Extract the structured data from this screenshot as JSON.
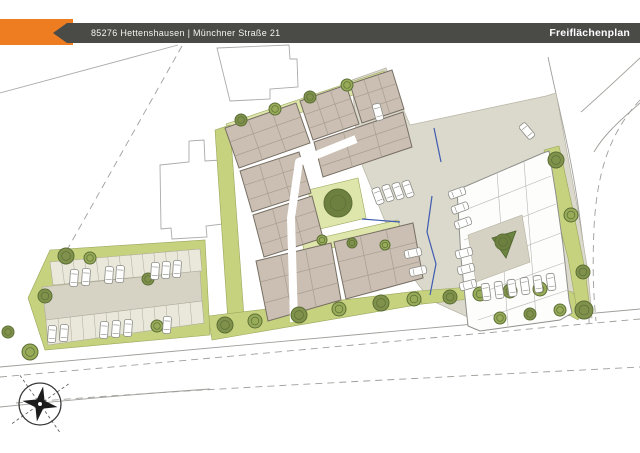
{
  "header": {
    "address": "85276 Hettenshausen | Münchner Straße 21",
    "title": "Freiflächenplan",
    "accent_color": "#ee7d22",
    "bar_color": "#4a4a47",
    "text_color": "#ffffff"
  },
  "plan": {
    "colors": {
      "paved": "#dbd8cc",
      "paved_stroke": "#b7b4a5",
      "green": "#c7d27e",
      "green_light": "#dfe6ab",
      "green_stroke": "#9aa65c",
      "tree_fill": "#7f914b",
      "tree_fill_alt": "#97ab58",
      "tree_dark": "#5c6f36",
      "building_fill": "#cabfb2",
      "building_stroke": "#776f64",
      "room_line": "#a79d90",
      "office_fill": "#fdfdfb",
      "office_stroke": "#8f8f8c",
      "office_line": "#b5b5b0",
      "courtyard_fill": "#d5d2c3",
      "triangle_fill": "#6b8440",
      "outline": "#ababab",
      "road_line": "#9e9e9a",
      "blue": "#3f5cb0",
      "compass": "#1c1c1c",
      "stall_fill": "#eae8da",
      "aisle_fill": "#d6d3c5"
    },
    "neighbor_outlines": [
      [
        [
          217,
          48
        ],
        [
          289,
          45
        ],
        [
          290,
          59
        ],
        [
          297,
          59
        ],
        [
          298,
          87
        ],
        [
          270,
          89
        ],
        [
          270,
          99
        ],
        [
          230,
          101
        ]
      ],
      [
        [
          160,
          165
        ],
        [
          189,
          162
        ],
        [
          189,
          141
        ],
        [
          204,
          140
        ],
        [
          205,
          161
        ],
        [
          221,
          160
        ],
        [
          223,
          224
        ],
        [
          206,
          226
        ],
        [
          207,
          237
        ],
        [
          172,
          239
        ],
        [
          171,
          228
        ],
        [
          161,
          229
        ]
      ]
    ],
    "boundary_solid": [
      "M178,45 L0,93"
    ],
    "roads_solid": [
      "M0,367 C160,353 340,336 640,309",
      "M0,407 C80,399 150,393 210,389",
      "M548,57 C558,105 570,150 578,205 C586,262 590,295 589,323",
      "M640,58 C612,84 596,99 581,112",
      "M640,103 C618,122 603,136 594,152"
    ],
    "roads_dashed": [
      "M0,377 C160,363 340,346 640,319",
      "M16,403 C200,388 430,378 640,367",
      "M182,46 L63,257",
      "M640,100 C612,130 597,168 594,228 C592,274 594,300 596,321"
    ],
    "paved_areas": [
      [
        [
          352,
          80
        ],
        [
          386,
          68
        ],
        [
          410,
          125
        ],
        [
          546,
          96
        ],
        [
          556,
          93
        ],
        [
          577,
          205
        ],
        [
          588,
          272
        ],
        [
          592,
          318
        ],
        [
          560,
          312
        ],
        [
          470,
          318
        ],
        [
          430,
          300
        ],
        [
          402,
          263
        ],
        [
          358,
          155
        ]
      ]
    ],
    "green_areas": [
      {
        "points": [
          [
            226,
            124
          ],
          [
            384,
            71
          ],
          [
            389,
            83
          ],
          [
            231,
            136
          ]
        ],
        "fill": "light"
      },
      {
        "points": [
          [
            215,
            130
          ],
          [
            230,
            125
          ],
          [
            245,
            330
          ],
          [
            229,
            336
          ]
        ],
        "fill": "green"
      },
      {
        "points": [
          [
            208,
            316
          ],
          [
            418,
            291
          ],
          [
            422,
            304
          ],
          [
            212,
            340
          ]
        ],
        "fill": "green"
      },
      {
        "points": [
          [
            418,
            291
          ],
          [
            470,
            287
          ],
          [
            538,
            282
          ],
          [
            572,
            292
          ],
          [
            585,
            307
          ],
          [
            578,
            320
          ],
          [
            538,
            298
          ],
          [
            470,
            299
          ],
          [
            422,
            304
          ]
        ],
        "fill": "green"
      },
      {
        "points": [
          [
            544,
            150
          ],
          [
            559,
            146
          ],
          [
            573,
            210
          ],
          [
            585,
            270
          ],
          [
            590,
            310
          ],
          [
            578,
            316
          ],
          [
            568,
            258
          ],
          [
            553,
            200
          ]
        ],
        "fill": "green"
      },
      {
        "points": [
          [
            308,
            190
          ],
          [
            358,
            178
          ],
          [
            366,
            218
          ],
          [
            316,
            230
          ]
        ],
        "fill": "light"
      },
      {
        "points": [
          [
            302,
            242
          ],
          [
            398,
            220
          ],
          [
            401,
            232
          ],
          [
            305,
            254
          ]
        ],
        "fill": "light"
      },
      {
        "points": [
          [
            28,
            298
          ],
          [
            50,
            250
          ],
          [
            205,
            240
          ],
          [
            210,
            335
          ],
          [
            45,
            350
          ]
        ],
        "fill": "green"
      }
    ],
    "parking_lot": {
      "band_top": [
        [
          50,
          262
        ],
        [
          200,
          249
        ],
        [
          202,
          271
        ],
        [
          53,
          285
        ]
      ],
      "aisle": [
        [
          42,
          287
        ],
        [
          200,
          271
        ],
        [
          202,
          301
        ],
        [
          46,
          320
        ]
      ],
      "band_bottom": [
        [
          46,
          320
        ],
        [
          202,
          301
        ],
        [
          204,
          323
        ],
        [
          48,
          345
        ]
      ],
      "stalls_per_band": 13
    },
    "main_building": {
      "wings": [
        [
          [
            225,
            128
          ],
          [
            296,
            103
          ],
          [
            310,
            143
          ],
          [
            239,
            168
          ]
        ],
        [
          [
            300,
            101
          ],
          [
            346,
            85
          ],
          [
            359,
            124
          ],
          [
            313,
            140
          ]
        ],
        [
          [
            350,
            84
          ],
          [
            392,
            70
          ],
          [
            404,
            109
          ],
          [
            362,
            123
          ]
        ],
        [
          [
            314,
            142
          ],
          [
            403,
            112
          ],
          [
            412,
            147
          ],
          [
            323,
            177
          ]
        ],
        [
          [
            240,
            171
          ],
          [
            299,
            152
          ],
          [
            311,
            193
          ],
          [
            252,
            212
          ]
        ],
        [
          [
            253,
            215
          ],
          [
            312,
            196
          ],
          [
            323,
            238
          ],
          [
            264,
            257
          ]
        ],
        [
          [
            256,
            261
          ],
          [
            331,
            243
          ],
          [
            341,
            300
          ],
          [
            268,
            321
          ]
        ],
        [
          [
            334,
            242
          ],
          [
            413,
            223
          ],
          [
            423,
            278
          ],
          [
            346,
            299
          ]
        ]
      ],
      "walkways": [
        "M356,139 L299,162 L291,218 L294,322"
      ]
    },
    "office_building": {
      "outline": [
        [
          457,
          190
        ],
        [
          543,
          153
        ],
        [
          549,
          151
        ],
        [
          556,
          195
        ],
        [
          563,
          245
        ],
        [
          569,
          300
        ],
        [
          572,
          313
        ],
        [
          560,
          320
        ],
        [
          480,
          331
        ],
        [
          468,
          326
        ],
        [
          461,
          258
        ]
      ],
      "inner_lines": [
        [
          460,
          212,
          551,
          176
        ],
        [
          464,
          240,
          556,
          204
        ],
        [
          468,
          268,
          561,
          233
        ],
        [
          472,
          296,
          566,
          262
        ],
        [
          478,
          320,
          568,
          290
        ],
        [
          497,
          172,
          508,
          326
        ],
        [
          524,
          162,
          536,
          316
        ]
      ],
      "courtyard": [
        [
          468,
          235
        ],
        [
          522,
          215
        ],
        [
          530,
          262
        ],
        [
          476,
          282
        ]
      ],
      "triangle": [
        [
          492,
          238
        ],
        [
          516,
          231
        ],
        [
          506,
          258
        ]
      ]
    },
    "blue_lines": [
      "M362,219 L400,222",
      "M432,196 L427,232 L436,264 L430,295",
      "M434,128 L441,162"
    ],
    "trees": [
      [
        241,
        120,
        6
      ],
      [
        275,
        109,
        6
      ],
      [
        310,
        97,
        6
      ],
      [
        347,
        85,
        6
      ],
      [
        338,
        203,
        14,
        1
      ],
      [
        322,
        240,
        5
      ],
      [
        352,
        243,
        5
      ],
      [
        385,
        245,
        5
      ],
      [
        225,
        325,
        8
      ],
      [
        255,
        321,
        7
      ],
      [
        299,
        315,
        8
      ],
      [
        339,
        309,
        7
      ],
      [
        381,
        303,
        8
      ],
      [
        414,
        299,
        7
      ],
      [
        450,
        297,
        7
      ],
      [
        480,
        294,
        7
      ],
      [
        510,
        291,
        7
      ],
      [
        540,
        289,
        7
      ],
      [
        584,
        310,
        9
      ],
      [
        500,
        318,
        6
      ],
      [
        530,
        314,
        6
      ],
      [
        560,
        310,
        6
      ],
      [
        556,
        160,
        8
      ],
      [
        571,
        215,
        7
      ],
      [
        583,
        272,
        7
      ],
      [
        503,
        242,
        8,
        1
      ],
      [
        66,
        256,
        8
      ],
      [
        90,
        258,
        6
      ],
      [
        148,
        279,
        6
      ],
      [
        157,
        326,
        6
      ],
      [
        45,
        296,
        7
      ],
      [
        30,
        352,
        8
      ],
      [
        8,
        332,
        6
      ]
    ],
    "cars": [
      [
        74,
        278,
        4
      ],
      [
        86,
        277,
        4
      ],
      [
        109,
        275,
        4
      ],
      [
        120,
        274,
        4
      ],
      [
        155,
        271,
        4
      ],
      [
        166,
        270,
        4
      ],
      [
        177,
        269,
        4
      ],
      [
        52,
        334,
        4
      ],
      [
        64,
        333,
        4
      ],
      [
        104,
        330,
        4
      ],
      [
        116,
        329,
        4
      ],
      [
        128,
        328,
        4
      ],
      [
        167,
        325,
        4
      ],
      [
        378,
        196,
        -20
      ],
      [
        388,
        193,
        -20
      ],
      [
        398,
        191,
        -20
      ],
      [
        408,
        189,
        -20
      ],
      [
        378,
        112,
        -15
      ],
      [
        527,
        131,
        -40
      ],
      [
        457,
        193,
        70
      ],
      [
        460,
        208,
        70
      ],
      [
        463,
        223,
        70
      ],
      [
        464,
        253,
        75
      ],
      [
        466,
        269,
        75
      ],
      [
        468,
        285,
        75
      ],
      [
        413,
        253,
        78
      ],
      [
        418,
        271,
        78
      ],
      [
        486,
        292,
        -8
      ],
      [
        499,
        290,
        -8
      ],
      [
        512,
        288,
        -8
      ],
      [
        525,
        286,
        -8
      ],
      [
        538,
        284,
        -8
      ],
      [
        551,
        282,
        -8
      ]
    ],
    "compass": {
      "cx": 40,
      "cy": 404,
      "r": 21,
      "rot": 10,
      "r_outer": 16,
      "r_inner": 5
    }
  }
}
